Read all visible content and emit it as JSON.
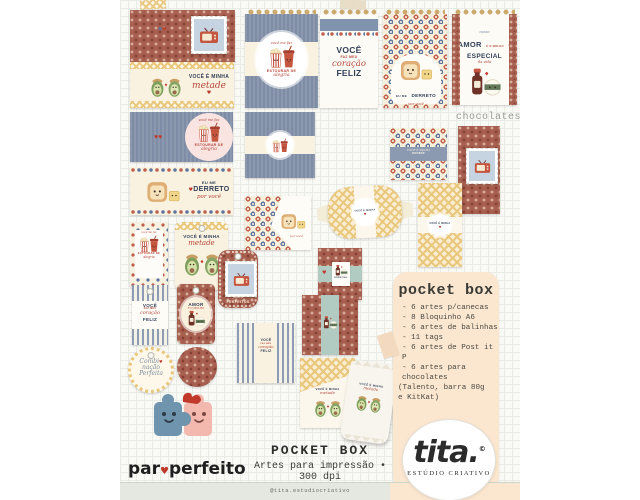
{
  "phrases": {
    "voce": "VOCÊ",
    "faz_meu": "FAZ MEU",
    "coracao": "coração",
    "feliz": "FELIZ",
    "voce_e_minha": "VOCÊ É MINHA",
    "metade": "metade",
    "voce_me_faz": "você me faz",
    "estourar_de": "ESTOURAR DE",
    "alegria": "alegria",
    "eu_me": "EU ME",
    "derreto": "DERRETO",
    "por_voce": "por você",
    "nosso": "nosso",
    "amor": "AMOR",
    "e_o_molho": "É O MOLHO",
    "especial": "ESPECIAL",
    "da_vida": "da vida",
    "juntos": "juntos",
    "perfeitos": "PERFEITOS",
    "combi": "Combi",
    "nacao": "nação",
    "perfeita": "Perfeita",
    "heart": "♥"
  },
  "labels": {
    "chocolates": "chocolates"
  },
  "panel": {
    "title": "pocket box",
    "items": [
      "- 6 artes p/canecas",
      "- 8 Bloquinho A6",
      "- 6 artes de balinhas",
      "- 11 tags",
      "- 6 artes de Post it P",
      "- 6 artes para chocolates",
      "(Talento, barra 80g",
      "e KitKat)"
    ]
  },
  "caption": {
    "title": "POCKET BOX",
    "subtitle": "Artes para impressão • 300 dpi"
  },
  "brand": {
    "par": "par",
    "perfeito": "perfeito",
    "tita": "tita.",
    "reg": "©",
    "estudio": "ESTÚDIO CRIATIVO",
    "handle": "@tita.estudiocriativo"
  },
  "colors": {
    "accent_red": "#b5463a",
    "navy": "#33405a",
    "blue_card": "#7e8ca5",
    "brown_card": "#a7604f",
    "teal_band": "#b2cbc2",
    "peach_panel": "#fbe6cf",
    "footer_gray": "#e4e8e1",
    "spiral_gold": "#cda86b",
    "cream": "#f8f1df"
  }
}
